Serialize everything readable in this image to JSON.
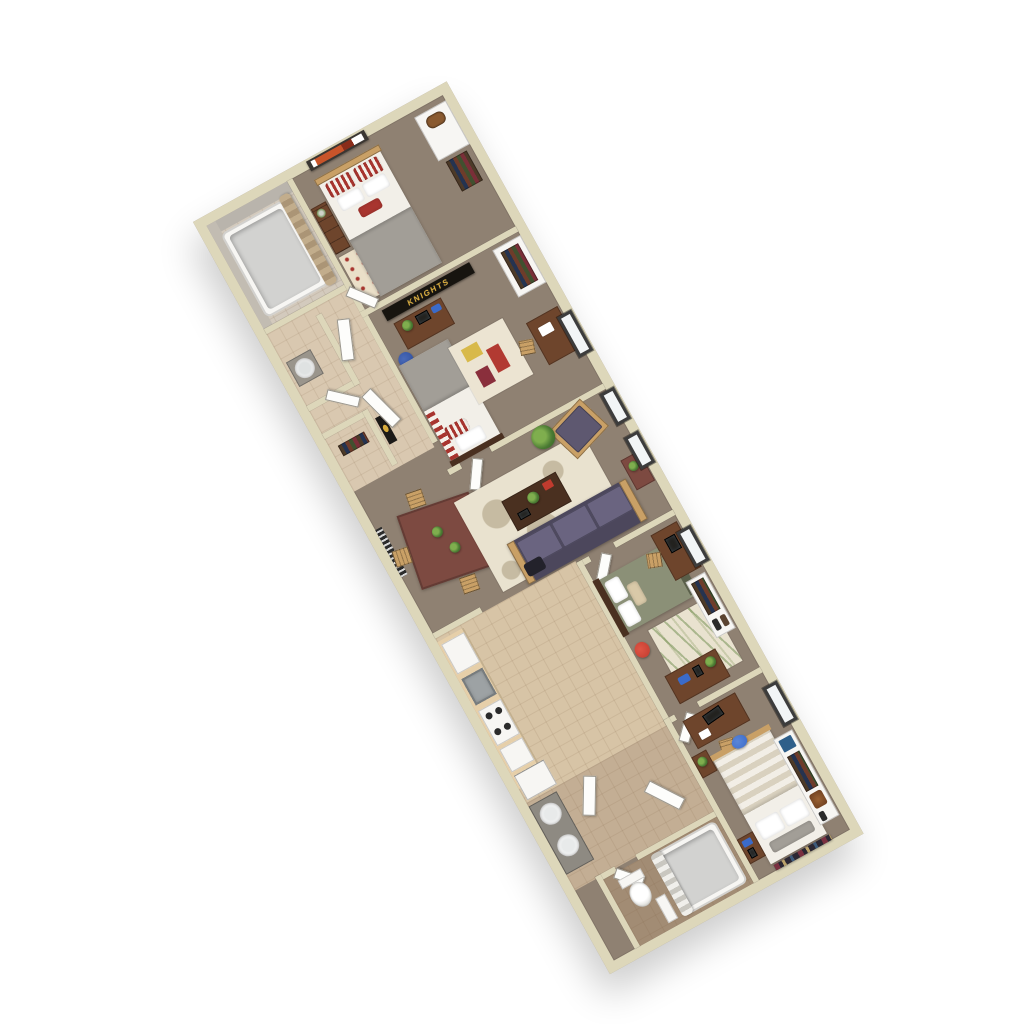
{
  "banner": {
    "text": "KNIGHTS"
  },
  "colors": {
    "bg": "#ffffff",
    "wall": "#ddd7ba",
    "wall-dark": "#c7c0a0",
    "carpet": "#8f8172",
    "tile-hall": "#d9c8b0",
    "tile-kitchen": "#d7c4a6",
    "tile-corridor": "#c3ae94",
    "tile-bath": "#a28c74",
    "tile-bathroom1": "#d3cabd",
    "wood": "#6e452c",
    "wood-dark": "#4a3020",
    "wood-light": "#c9a066",
    "counter": "#e6cfa9",
    "sofa": "#5e5870",
    "sofa-dark": "#4c475c",
    "cushion": "#6a6480",
    "bed-white": "#f2efe8",
    "blanket": "#a29e97",
    "sage": "#8b9077",
    "sage-dark": "#5a5f4a",
    "stripe-red": "#a8352f",
    "banner-bg": "#17140f",
    "banner-gold": "#d8ab3c",
    "fixture": "#f7f6f3",
    "tub-inner": "#d2d2d0",
    "steel": "#9da2a4",
    "window-frame": "#3c3c3c",
    "glass": "#f2f5f6",
    "rug-cream": "#e9e2cf",
    "rug-taupe": "#c6bba2",
    "plant": "#4a7a33",
    "plant-dark": "#2f5c22",
    "blue": "#3b6bc9",
    "navy": "#2f4f9e",
    "red": "#c03b2e",
    "maroon": "#7d4a41",
    "curtain": "#c2ad8c"
  }
}
